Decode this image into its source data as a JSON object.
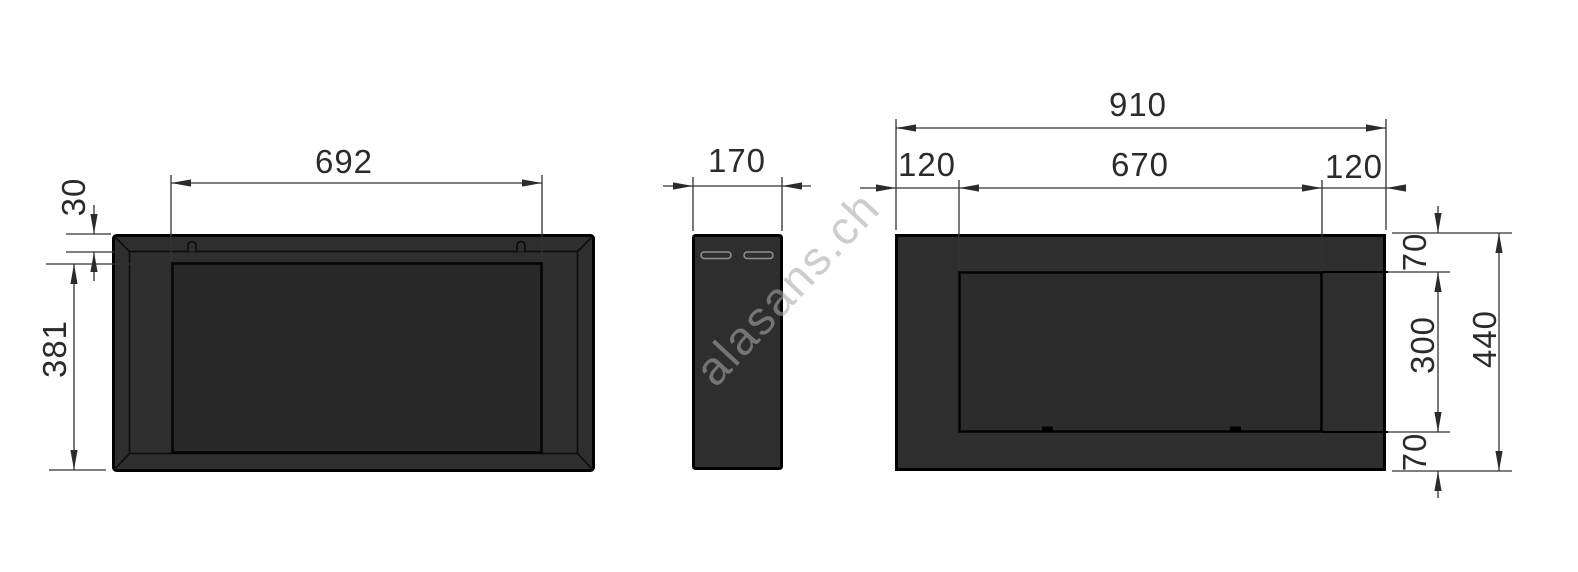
{
  "watermark": {
    "text": "alasans.ch"
  },
  "front_view": {
    "dims": {
      "opening_width": "692",
      "mount_offset": "30",
      "front_height": "381"
    }
  },
  "side_view": {
    "dims": {
      "depth": "170"
    }
  },
  "rear_view": {
    "dims": {
      "overall_width": "910",
      "left_inset": "120",
      "opening_width": "670",
      "right_inset": "120",
      "top_inset": "70",
      "opening_height": "300",
      "bottom_inset": "70",
      "overall_height": "440"
    }
  },
  "colors": {
    "body_fill": "#2e2e2e",
    "panel_fill": "#292929",
    "outline": "#000000",
    "dimension": "#333333",
    "watermark": "#a8a8a8",
    "background": "#ffffff"
  }
}
